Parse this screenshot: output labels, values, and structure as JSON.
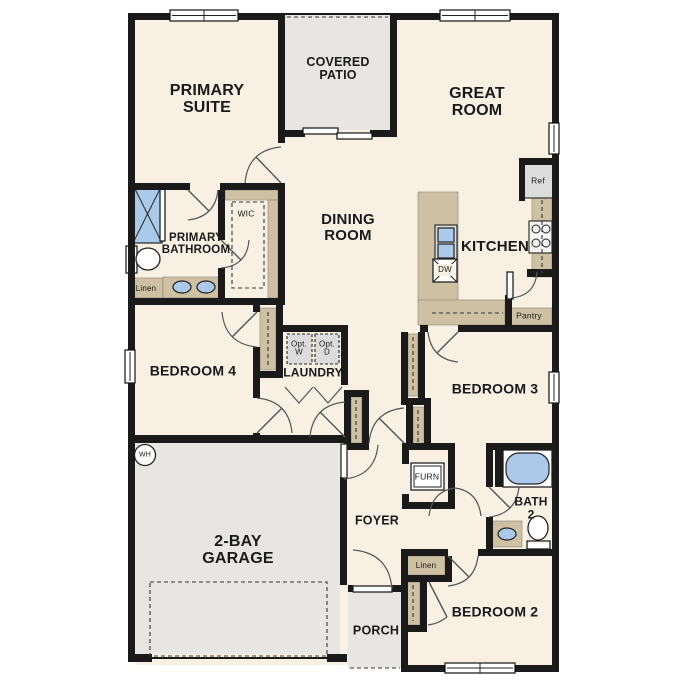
{
  "colors": {
    "wall": "#1a1a1a",
    "floor": "#f8f1e3",
    "outdoor": "#e7e6e3",
    "casework": "#cec0a2",
    "fixture": "#abc9e9",
    "appliance": "#dcdcdc",
    "text": "#1a1a1a",
    "background": "#ffffff"
  },
  "rooms": {
    "primary_suite": "PRIMARY\nSUITE",
    "covered_patio": "COVERED\nPATIO",
    "great_room": "GREAT\nROOM",
    "dining_room": "DINING\nROOM",
    "kitchen": "KITCHEN",
    "primary_bathroom": "PRIMARY\nBATHROOM",
    "bedroom_4": "BEDROOM 4",
    "laundry": "LAUNDRY",
    "bedroom_3": "BEDROOM 3",
    "bath_2": "BATH\n2",
    "foyer": "FOYER",
    "garage": "2-BAY\nGARAGE",
    "porch": "PORCH",
    "bedroom_2": "BEDROOM 2"
  },
  "features": {
    "wic": "WIC",
    "linen_primary": "Linen",
    "linen_hall": "Linen",
    "pantry": "Pantry",
    "furnace": "FURN",
    "opt_washer": "Opt.\nW",
    "opt_dryer": "Opt.\nD"
  },
  "appliances": {
    "refrigerator": "Ref",
    "dishwasher": "DW",
    "water_heater": "WH"
  }
}
